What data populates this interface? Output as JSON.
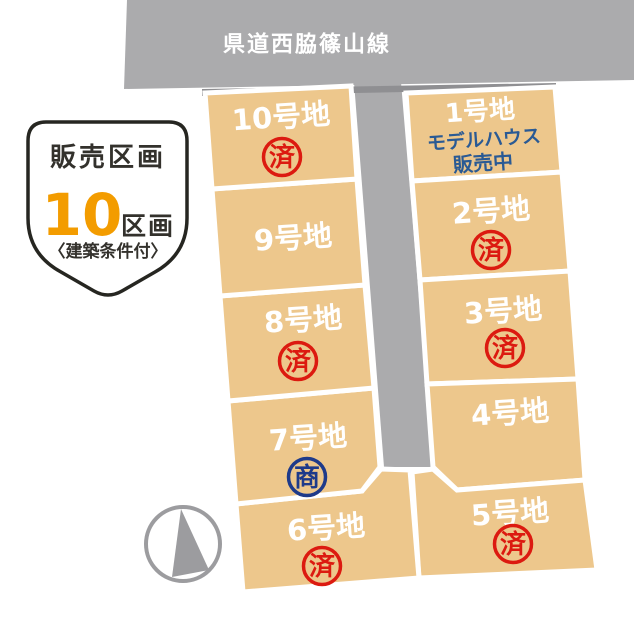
{
  "colors": {
    "lot_fill": "#edc78c",
    "road_fill": "#ababad",
    "road_shadow": "#8f8f92",
    "sold_red": "#dc1a10",
    "negotiating_navy": "#1e3a8a",
    "model_house_blue": "#2a5a94",
    "badge_orange": "#f39c00",
    "badge_text": "#33312c",
    "badge_border": "#262621",
    "compass_gray": "#9c9c9f",
    "lot_label_white": "#ffffff"
  },
  "roads": {
    "top_label": "県道西脇篠山線"
  },
  "badge": {
    "title": "販売区画",
    "count": "10",
    "count_unit": "区画",
    "note": "〈建築条件付〉"
  },
  "lots": [
    {
      "name": "1号地",
      "sub_line1": "モデルハウス",
      "sub_line2": "販売中"
    },
    {
      "name": "2号地",
      "stamp": "済",
      "stamp_color": "#dc1a10"
    },
    {
      "name": "3号地",
      "stamp": "済",
      "stamp_color": "#dc1a10"
    },
    {
      "name": "4号地"
    },
    {
      "name": "5号地",
      "stamp": "済",
      "stamp_color": "#dc1a10"
    },
    {
      "name": "6号地",
      "stamp": "済",
      "stamp_color": "#dc1a10"
    },
    {
      "name": "7号地",
      "stamp": "商",
      "stamp_color": "#1e3a8a"
    },
    {
      "name": "8号地",
      "stamp": "済",
      "stamp_color": "#dc1a10"
    },
    {
      "name": "9号地"
    },
    {
      "name": "10号地",
      "stamp": "済",
      "stamp_color": "#dc1a10"
    }
  ]
}
